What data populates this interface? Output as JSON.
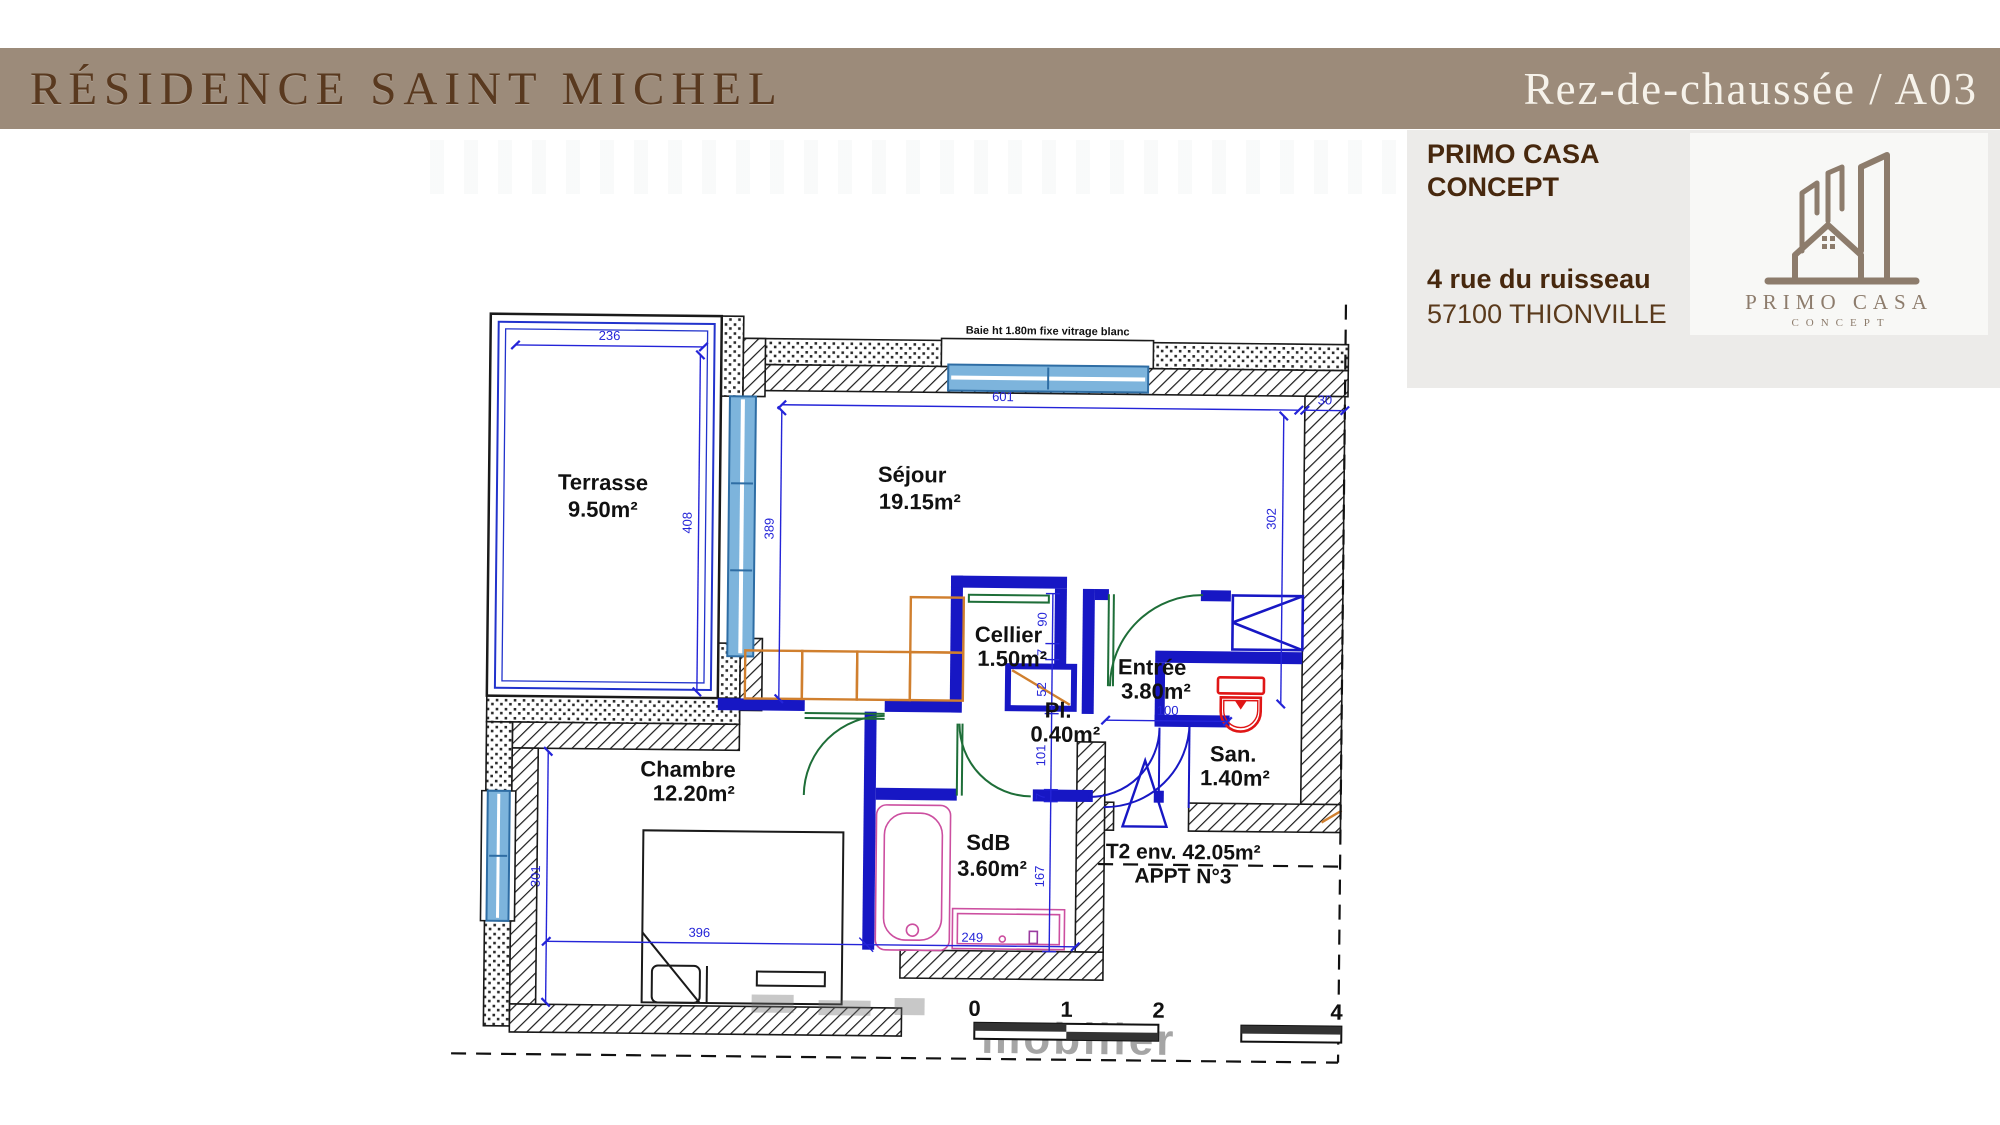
{
  "header": {
    "left_title": "RÉSIDENCE SAINT MICHEL",
    "right_title": "Rez-de-chaussée / A03",
    "band_color": "#9c8b7a"
  },
  "agency": {
    "name_line1": "PRIMO CASA",
    "name_line2": "CONCEPT",
    "address_line1": "4 rue du ruisseau",
    "address_line2": "57100 THIONVILLE",
    "logo_title": "PRIMO CASA",
    "logo_subtitle": "CONCEPT"
  },
  "plan": {
    "window_note": "Baie ht 1.80m fixe vitrage blanc",
    "rooms": [
      {
        "name": "Terrasse",
        "area": "9.50m²"
      },
      {
        "name": "Séjour",
        "area": "19.15m²"
      },
      {
        "name": "Cellier",
        "area": "1.50m²"
      },
      {
        "name": "Pl.",
        "area": "0.40m²"
      },
      {
        "name": "Entrée",
        "area": "3.80m²"
      },
      {
        "name": "San.",
        "area": "1.40m²"
      },
      {
        "name": "Chambre",
        "area": "12.20m²"
      },
      {
        "name": "SdB",
        "area": "3.60m²"
      }
    ],
    "summary": {
      "type_label": "T2 env. 42.05m²",
      "apartment_label": "APPT N°3"
    },
    "dims": {
      "terrasse_width": "236",
      "terrasse_depth": "408",
      "sejour_left_height": "389",
      "sejour_width": "601",
      "wall_thickness": "30",
      "sejour_right_height": "302",
      "entree_width": "100",
      "chambre_height": "301",
      "chambre_width": "396",
      "sdb_width": "249",
      "chain": [
        "90",
        "7",
        "52",
        "101",
        "7",
        "167"
      ]
    },
    "scale_bar": {
      "labels": [
        "0",
        "1",
        "2",
        "4"
      ]
    },
    "watermark": "mobilier",
    "colors": {
      "exterior_wall": "#1a1a1a",
      "partition_blue": "#1717c4",
      "dimension_blue": "#2424d8",
      "window_fill": "#7db4dc",
      "door_green": "#1e6e38",
      "kitchen_orange": "#d07f2e",
      "bath_pink": "#cc4fa0",
      "toilet_red": "#e01616"
    }
  }
}
